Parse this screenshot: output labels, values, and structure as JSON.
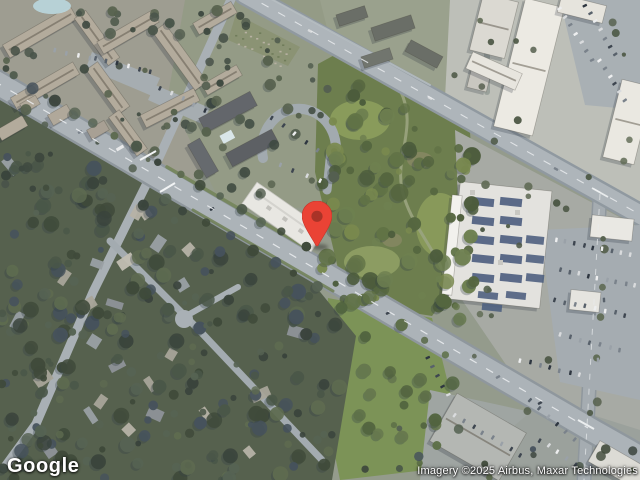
{
  "map": {
    "view": "satellite",
    "watermark": "Google",
    "attribution": "Imagery ©2025 Airbus, Maxar Technologies"
  },
  "marker": {
    "label": "selected location pin",
    "pin_color": "#EA4335",
    "dot_color": "#A93327",
    "x": 317,
    "y": 247
  },
  "colors": {
    "base": "#949B8C",
    "road": "#ACB3B8",
    "roadEdge": "#8F979D",
    "minorRoad": "#A8AFB4",
    "park": "#6D7E4E",
    "field": "#7C9357",
    "residentialBase": "#56614E",
    "urbanBase": "#9E9D91",
    "apartmentRoof": "#B3AB9C",
    "warehouseRoof": "#ECEAE3",
    "commercialRoof": "#E3E2DE",
    "solarPanel": "#4F6080",
    "poolWater": "#B8D4DA"
  }
}
